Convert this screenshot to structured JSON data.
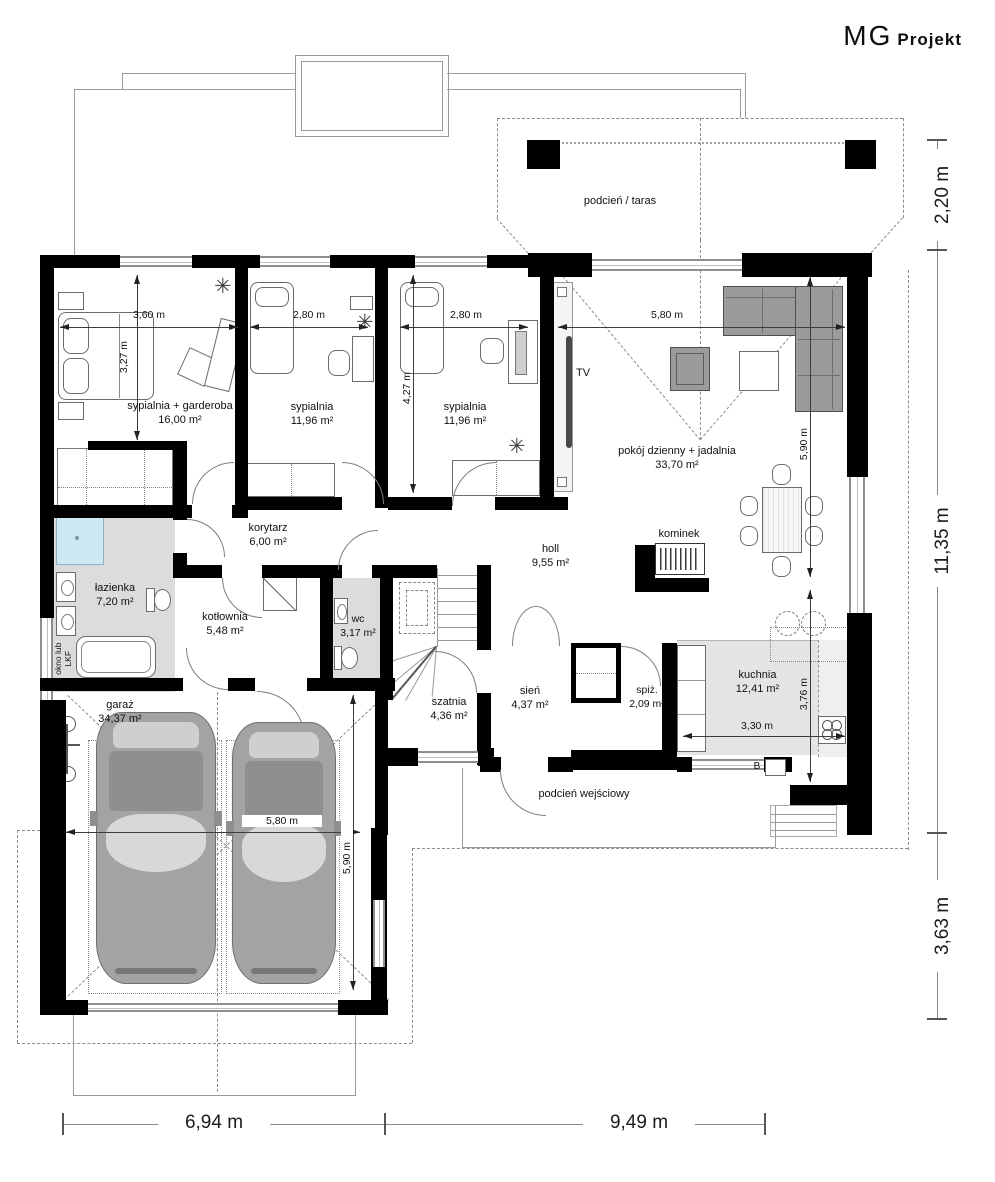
{
  "brand": {
    "mg": "MG",
    "projekt": "Projekt"
  },
  "rooms": {
    "taras": {
      "name": "podcień / taras"
    },
    "bed1": {
      "name": "sypialnia + garderoba",
      "area": "16,00 m²"
    },
    "bed2": {
      "name": "sypialnia",
      "area": "11,96 m²"
    },
    "bed3": {
      "name": "sypialnia",
      "area": "11,96 m²"
    },
    "living": {
      "name": "pokój dzienny + jadalnia",
      "area": "33,70 m²"
    },
    "korytarz": {
      "name": "korytarz",
      "area": "6,00 m²"
    },
    "lazienka": {
      "name": "łazienka",
      "area": "7,20 m²"
    },
    "kotlownia": {
      "name": "kotłownia",
      "area": "5,48 m²"
    },
    "wc": {
      "name": "wc",
      "area": "3,17 m²"
    },
    "holl": {
      "name": "holl",
      "area": "9,55 m²"
    },
    "kominek": {
      "name": "kominek"
    },
    "szatnia": {
      "name": "szatnia",
      "area": "4,36 m²"
    },
    "sien": {
      "name": "sień",
      "area": "4,37 m²"
    },
    "spiz": {
      "name": "spiż.",
      "area": "2,09 m²"
    },
    "kuchnia": {
      "name": "kuchnia",
      "area": "12,41 m²"
    },
    "garaz": {
      "name": "garaż",
      "area": "34,37 m²"
    },
    "wejscie": {
      "name": "podcień wejściowy"
    }
  },
  "annotations": {
    "tv": "TV",
    "okno1": "okno lub",
    "okno2": "LKF",
    "b": "B"
  },
  "icons": {
    "plant": "✳"
  },
  "dims": {
    "bed1_w": "3,60 m",
    "bed1_h": "3,27 m",
    "bed2_w": "2,80 m",
    "bed3_w": "2,80 m",
    "bed3_h": "4,27 m",
    "living_w": "5,80 m",
    "living_h": "5,90 m",
    "kuchnia_w": "3,30 m",
    "kuchnia_h": "3,76 m",
    "garaz_w": "5,80 m",
    "garaz_h": "5,90 m",
    "ext_top": "2,20 m",
    "ext_mid": "11,35 m",
    "ext_bottom": "3,63 m",
    "ext_left": "6,94 m",
    "ext_right": "9,49 m"
  },
  "colors": {
    "wall": "#000000",
    "floor_gray": "#dcdcdc",
    "kitchen_floor": "#e4e4e4",
    "shower_blue": "#cfe9f2",
    "sofa_gray": "#9b9b9b",
    "car_gray": "#a3a3a3"
  }
}
